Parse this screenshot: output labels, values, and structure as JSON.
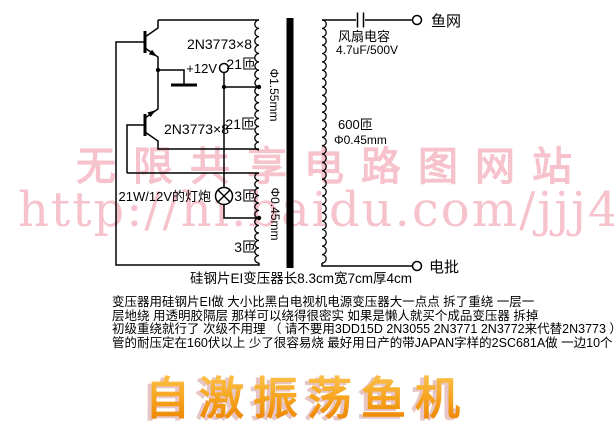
{
  "watermark": {
    "line1": "无限共享电路图网站",
    "line2": "http://hi.baidu.com/jjj4",
    "color": "#f6c3cd"
  },
  "schematic": {
    "transistor_top_label": "2N3773×8",
    "transistor_bottom_label": "2N3773×8",
    "supply_label": "+12V",
    "primary_upper_turns": "21匝",
    "primary_lower_turns": "21匝",
    "primary_wire_gauge": "Φ1.55mm",
    "feedback_upper_turns": "3匝",
    "feedback_lower_turns": "3匝",
    "feedback_wire_gauge": "Φ0.45mm",
    "lamp_label": "21W/12V的灯炮",
    "capacitor_name": "风扇电容",
    "capacitor_value": "4.7uF/500V",
    "secondary_turns": "600匝",
    "secondary_wire_gauge": "Φ0.45mm",
    "terminal_top": "鱼网",
    "terminal_bottom": "电批",
    "core_caption": "硅钢片EI变压器长8.3cm宽7cm厚4cm"
  },
  "notes": {
    "line1": "变压器用硅钢片EI做 大小比黑白电视机电源变压器大一点点 拆了重绕 一层一",
    "line2": "层地绕 用透明胶隔层 那样可以绕得很密实 如果是懒人就买个成品变压器 拆掉",
    "line3": "初级重绕就行了 次级不用理 （ 请不要用3DD15D 2N3055 2N3771 2N3772来代替2N3773 ）",
    "line4": "管的耐压定在160伏以上 少了很容易烧 最好用日产的带JAPAN字样的2SC681A做 一边10个"
  },
  "title": {
    "text": "自激振荡鱼机",
    "color_top": "#fdca58",
    "color_bottom": "#ec8200"
  }
}
